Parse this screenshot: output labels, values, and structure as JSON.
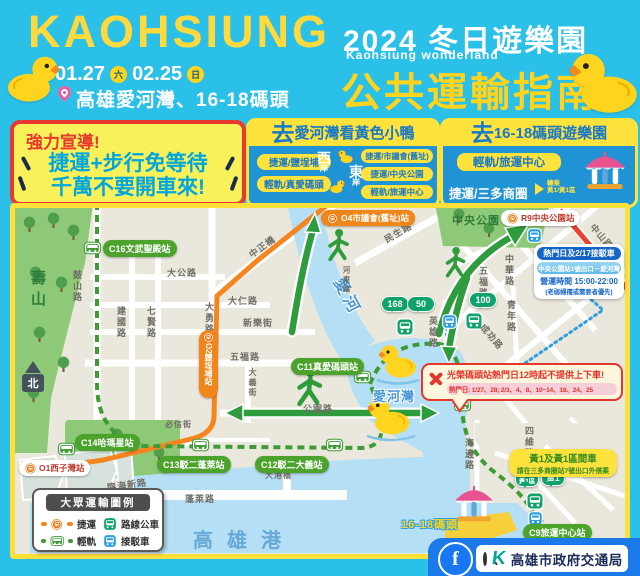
{
  "colors": {
    "background_cyan": "#2BC0E8",
    "brand_yellow": "#FFD93E",
    "metro_orange": "#F08519",
    "red_line": "#E8432F",
    "lrt_green": "#3E9B35",
    "route_green": "#2E9C3C",
    "shuttle_blue": "#2D9FE0",
    "footer_blue": "#1C79E9",
    "facebook_blue": "#1877F2"
  },
  "header": {
    "brand": "KAOHSIUNG",
    "date_start": "01.27",
    "date_start_day": "六",
    "date_end": "02.25",
    "date_end_day": "日",
    "location": "高雄愛河灣、16-18碼頭",
    "event_title": "2024 冬日遊樂園",
    "event_subtitle": "Kaohsiung wonderland",
    "guide_title": "公共運輸指南"
  },
  "notice": {
    "heading": "強力宣導!",
    "line1": "捷運+步行免等待",
    "line2": "千萬不要開車來!"
  },
  "bay_box": {
    "title_prefix": "去",
    "title": "愛河灣看黃色小鴨",
    "west_big": "西",
    "west_small": "岸",
    "east_big": "東",
    "east_small": "岸",
    "west_items": [
      "捷運/鹽埕埔",
      "輕軌/真愛碼頭"
    ],
    "east_items": [
      "捷運/市議會(舊址)",
      "捷運/中央公園",
      "輕軌/旅運中心"
    ]
  },
  "pier_box": {
    "title_prefix": "去",
    "title": "16-18碼頭遊樂園",
    "item1": "輕軌/旅運中心",
    "item2": "捷運/三多商圈",
    "transfer_label": "轉乘",
    "transfer_routes": "黃1/黃1區"
  },
  "map": {
    "areas": {
      "shoushan": "壽山",
      "central_park": "中央公園",
      "river": "愛河",
      "bay": "愛河灣",
      "harbor": "高雄港",
      "pier": "16-18碼頭",
      "bridge": "大港橋",
      "compass": "北"
    },
    "stations": {
      "c16": "C16文武聖殿站",
      "c14": "C14哈瑪星站",
      "c13": "C13駁二蓬萊站",
      "c12": "C12駁二大義站",
      "c11": "C11真愛碼頭站",
      "c9": "C9旅運中心站",
      "o1": "O1西子灣站",
      "o2": "O2鹽埕埔站",
      "o4": "O4市議會(舊址)站",
      "r9": "R9中央公園站"
    },
    "roads": {
      "gushan": "鼓山路",
      "dagong": "大公路",
      "daren": "大仁路",
      "xinle": "新樂街",
      "jianguo": "建國路",
      "qixian": "七賢路",
      "dayong": "大勇路",
      "zhongzheng": "中正橋",
      "minsheng": "民生路",
      "hedong": "河東路",
      "wufu_w": "五福路",
      "gongyuan": "公園路",
      "dayi": "大義街",
      "bixin": "必信街",
      "linhai": "臨海新路",
      "penglai": "蓬萊路",
      "wufu_e": "五福路",
      "zhonghua": "中華路",
      "zhongshan": "中山路",
      "qingnian": "青年路",
      "yingxiong": "英雄路",
      "chenggong": "成功路",
      "siwei": "四維路",
      "haibian": "海邊路"
    },
    "bus_stops": {
      "b168": "168",
      "b50": "50",
      "b100": "100",
      "y1": "黃1",
      "y1s": "黃1區"
    },
    "shuttle_box": {
      "title": "熱門日及2/17接駁車",
      "route": "中央公園站1號出口－愛河灣",
      "hours": "營運時間 15:00-22:00",
      "note": "(老弱婦孺或需要者優先)"
    },
    "warning": {
      "text": "光榮碼頭站熱門日12時起不提供上下車!",
      "dates": "熱門日: 1/27、28; 2/3、4、8、10~14、18、24、25"
    },
    "y1_note": {
      "line1": "黃1及黃1區間車",
      "line2": "請在三多商圈站7號出口外搭乘"
    }
  },
  "legend": {
    "title": "大眾運輸圖例",
    "metro": "捷運",
    "lrt": "輕軌",
    "bus": "路線公車",
    "shuttle": "接駁車"
  },
  "footer": {
    "facebook_letter": "f",
    "logo_letter": "K",
    "agency": "高雄市政府交通局"
  }
}
